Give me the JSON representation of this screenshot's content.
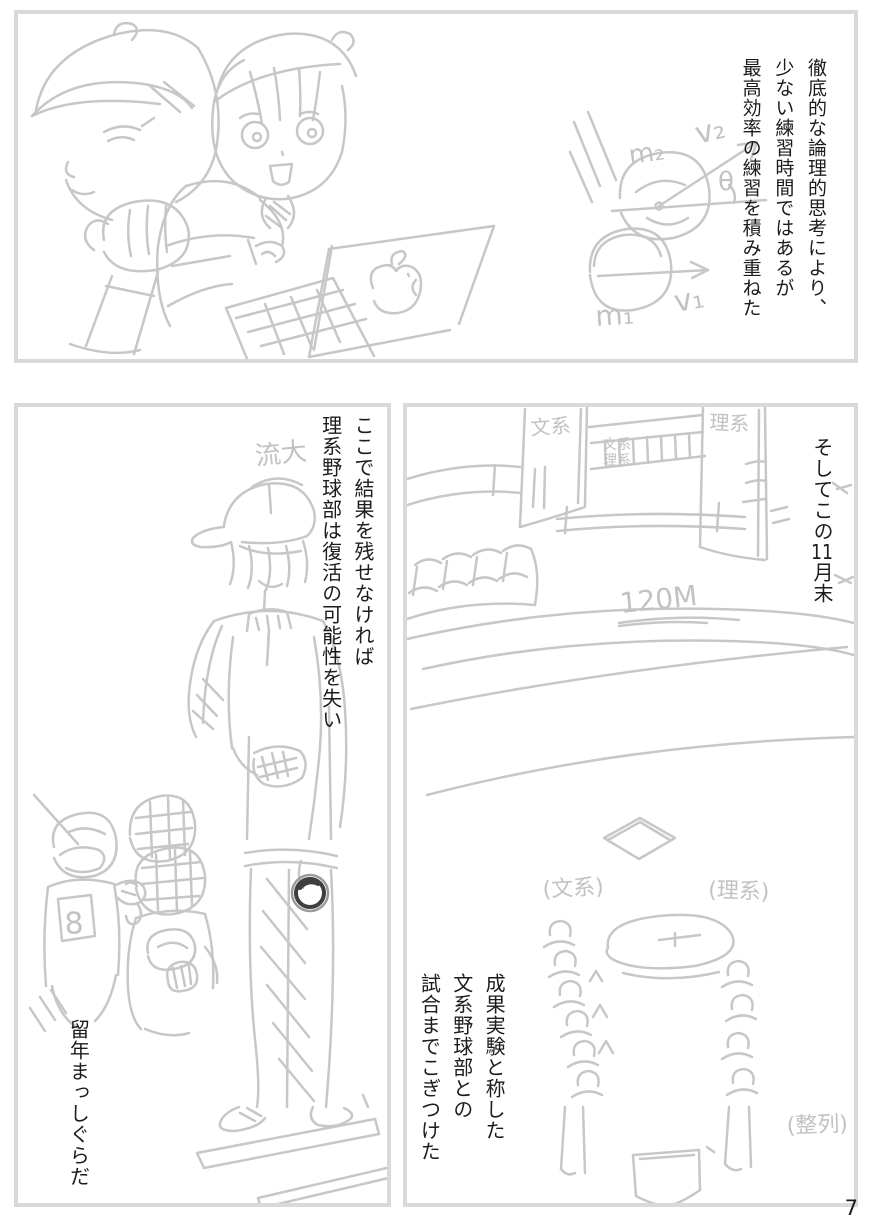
{
  "page": {
    "number": "7"
  },
  "panel1": {
    "caption": [
      "徹底的な論理的思考により、",
      "少ない練習時間ではあるが",
      "最高効率の練習を積み重ねた"
    ],
    "diagram": {
      "m2": "m₂",
      "v2": "v₂",
      "theta": "θ",
      "m1": "m₁",
      "v1": "v₁"
    }
  },
  "panel2": {
    "caption_top": [
      "ここで結果を残せなければ",
      "理系野球部は復活の可能性を失い"
    ],
    "caption_bottom": "留年まっしぐらだ",
    "cap_label": "流大",
    "jersey_number": "8"
  },
  "panel3": {
    "caption_top_parts": [
      "そしてこの",
      "11",
      "月末"
    ],
    "caption_bottom": [
      "成果実験と称した",
      "文系野球部との",
      "試合までこぎつけた"
    ],
    "labels": {
      "building_left": "文系",
      "building_right": "理系",
      "bridge_upper": "文系",
      "bridge_lower": "理系",
      "distance": "120M",
      "team_left": "(文系)",
      "team_right": "(理系)",
      "lineup": "(整列)"
    }
  },
  "colors": {
    "sketch": "#c7c7c7",
    "ink": "#1c1c1c",
    "panel_border": "#d9d9d9",
    "ball": "#3f3f3f"
  }
}
